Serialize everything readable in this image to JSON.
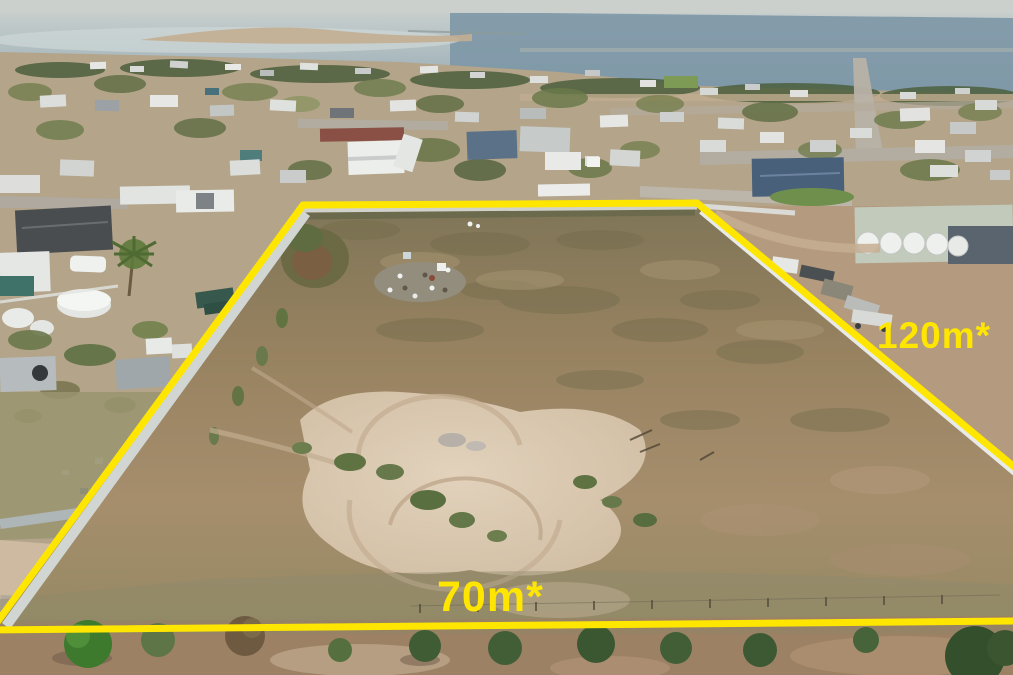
{
  "meta": {
    "type": "aerial-drone-photograph",
    "subject": "vacant residential land allotment outlined with a yellow boundary overlay, coastal country town and bay in the background"
  },
  "annotations": {
    "right_label": "120m*",
    "bottom_label": "70m*",
    "right_dimension": {
      "value": 120,
      "unit": "m",
      "approximate": true
    },
    "bottom_dimension": {
      "value": 70,
      "unit": "m",
      "approximate": true
    },
    "boundary_color": "#ffe600",
    "label_color": "#ffe600"
  },
  "scene": {
    "background": "bay water, distant shoreline, township rooftops and trees",
    "midground": "fenced vacant paddock of dry grass, sand patch with circular vehicle tracks, rubble pile",
    "foreground": "roadside verge with a row of trees",
    "water_color": "#7d97a6",
    "dirt_color": "#a18a6c",
    "sand_color": "#dcc9b2",
    "fence_color": "#e6e8e6"
  }
}
